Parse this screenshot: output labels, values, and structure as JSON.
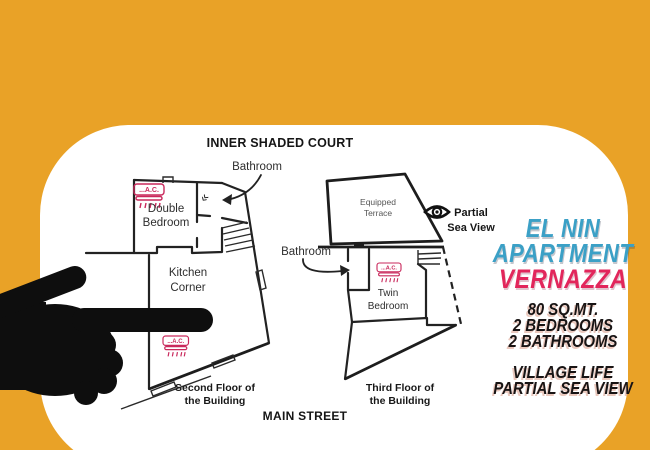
{
  "colors": {
    "background": "#E9A227",
    "card": "#FFFFFF",
    "title_blue": "#3BA0C6",
    "title_pink": "#E2265B",
    "ac_pink": "#C9295C",
    "plan_ink": "#222222"
  },
  "card": {
    "court_label": "INNER SHADED COURT",
    "street_label": "MAIN STREET"
  },
  "floorplans": {
    "ac_label": "...A.C.",
    "second": {
      "bathroom_label": "Bathroom",
      "bedroom_line1": "Double",
      "bedroom_line2": "Bedroom",
      "kitchen_line1": "Kitchen",
      "kitchen_line2": "Corner",
      "caption_line1": "Second Floor of",
      "caption_line2": "the Building"
    },
    "third": {
      "terrace_line1": "Equipped",
      "terrace_line2": "Terrace",
      "bathroom_label": "Bathroom",
      "bedroom_line1": "Twin",
      "bedroom_line2": "Bedroom",
      "seaview_line1": "Partial",
      "seaview_line2": "Sea View",
      "caption_line1": "Third Floor of",
      "caption_line2": "the Building"
    }
  },
  "info_panel": {
    "title_line1": "EL NIN",
    "title_line2": "APARTMENT",
    "title_line3": "VERNAZZA",
    "stats": [
      "80 SQ.MT.",
      "2 BEDROOMS",
      "2 BATHROOMS"
    ],
    "features": [
      "VILLAGE LIFE",
      "PARTIAL SEA VIEW"
    ]
  }
}
